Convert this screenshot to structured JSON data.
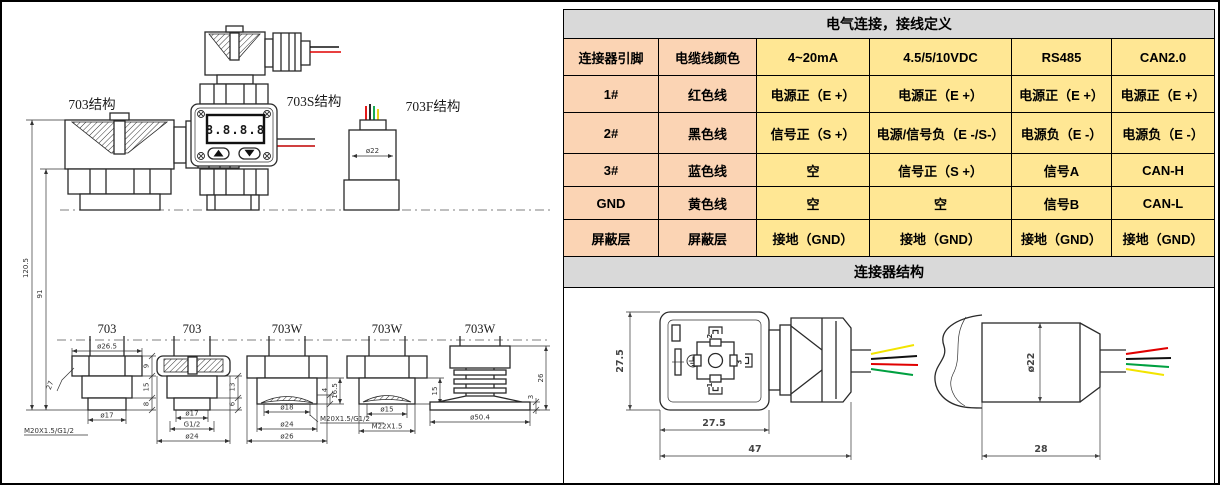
{
  "drawings": {
    "labels": {
      "s703": "703结构",
      "s703s": "703S结构",
      "s703f": "703F结构"
    },
    "lcd": "8.8.8.8",
    "dims": {
      "total_h": "120.5",
      "body_h": "91",
      "f_dia": "ø22",
      "f1": {
        "label": "703",
        "d1": "ø26.5",
        "d2": "9",
        "d3": "15",
        "d4": "8",
        "d5": "ø17",
        "d6": "M20X1.5/G1/2",
        "d7": "27"
      },
      "f2": {
        "label": "703",
        "d1": "13",
        "d2": "6",
        "d3": "ø17",
        "d4": "G1/2",
        "d5": "ø24"
      },
      "f3": {
        "label": "703W",
        "d1": "16.5",
        "d2": "4",
        "d3": "ø18",
        "d4": "M20X1.5/G1/2",
        "d5": "ø24",
        "d6": "ø26"
      },
      "f4": {
        "label": "703W",
        "d1": "15",
        "d2": "ø15",
        "d3": "M22X1.5"
      },
      "f5": {
        "label": "703W",
        "d1": "26",
        "d2": "3",
        "d3": "ø50.4"
      }
    }
  },
  "table": {
    "title": "电气连接，接线定义",
    "headers": [
      "连接器引脚",
      "电缆线颜色",
      "4~20mA",
      "4.5/5/10VDC",
      "RS485",
      "CAN2.0"
    ],
    "rows": [
      [
        "1#",
        "红色线",
        "电源正（E +）",
        "电源正（E +）",
        "电源正（E +）",
        "电源正（E +）"
      ],
      [
        "2#",
        "黑色线",
        "信号正（S +）",
        "电源/信号负（E -/S-）",
        "电源负（E -）",
        "电源负（E -）"
      ],
      [
        "3#",
        "蓝色线",
        "空",
        "信号正（S +）",
        "信号A",
        "CAN-H"
      ],
      [
        "GND",
        "黄色线",
        "空",
        "空",
        "信号B",
        "CAN-L"
      ],
      [
        "屏蔽层",
        "屏蔽层",
        "接地（GND）",
        "接地（GND）",
        "接地（GND）",
        "接地（GND）"
      ]
    ],
    "section2_title": "连接器结构"
  },
  "connector": {
    "din": {
      "h": "27.5",
      "w": "27.5",
      "len": "47",
      "pin1": "1",
      "pin2": "2",
      "pin3": "3"
    },
    "cyl": {
      "dia": "ø22",
      "len": "28"
    }
  },
  "colors": {
    "title_bg": "#d9d9d9",
    "pin_col_bg": "#fbd4b4",
    "cell_bg": "#ffe794",
    "wire_red": "#e00000",
    "wire_black": "#111111",
    "wire_green": "#00a040",
    "wire_yellow": "#f2e400"
  }
}
